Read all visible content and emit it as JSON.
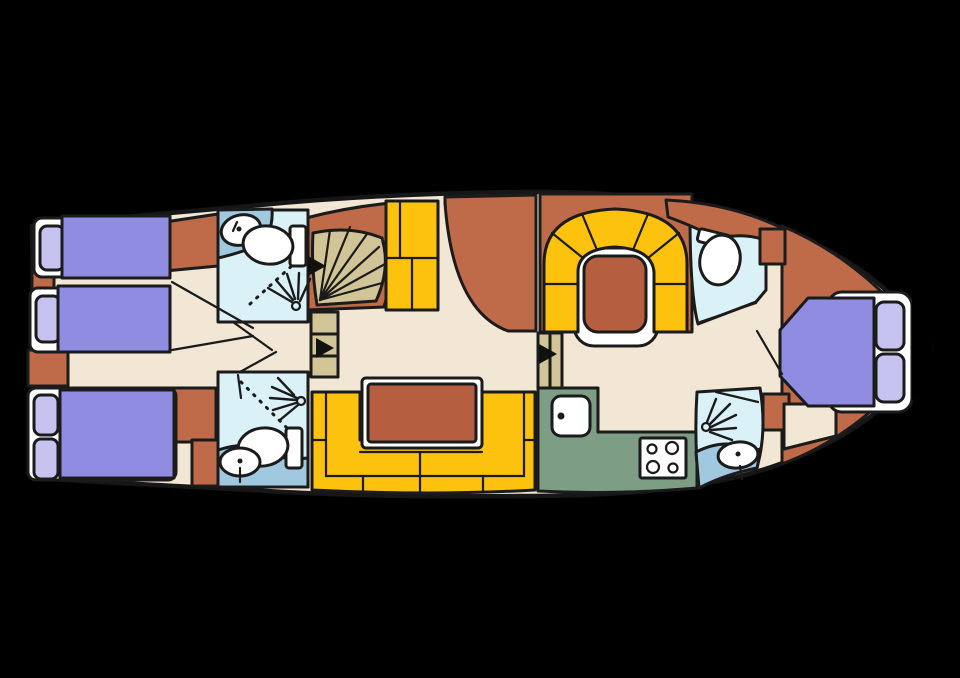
{
  "figure": {
    "kind": "yacht-deck-floor-plan",
    "orientation": "bow-right",
    "rooms": [
      "stern-cabin-upper",
      "stern-cabin-lower",
      "bathroom-port-aft",
      "bathroom-starboard-aft",
      "saloon",
      "galley",
      "dinette",
      "bathroom-port-fwd",
      "bathroom-starboard-fwd",
      "bow-cabin"
    ],
    "fixtures": [
      "toilet",
      "sink",
      "shower",
      "stove",
      "stairs",
      "companionway-steps",
      "door-arrow"
    ]
  },
  "palette": {
    "background": "#000000",
    "outline": "#1b1b1b",
    "floor": "#f1e7d4",
    "terracotta": "#bf6b4a",
    "table_brown": "#b65f40",
    "blanket_purple": "#8f8ce1",
    "pillow_lavender": "#c6c3f0",
    "white": "#ffffff",
    "bath_blue": "#d9f1f7",
    "bath_wet_blue": "#a0c9e0",
    "seating_yellow": "#fcc20d",
    "stairs_tan": "#d1c496",
    "galley_green": "#7e9d85",
    "arrow_black": "#111111"
  }
}
